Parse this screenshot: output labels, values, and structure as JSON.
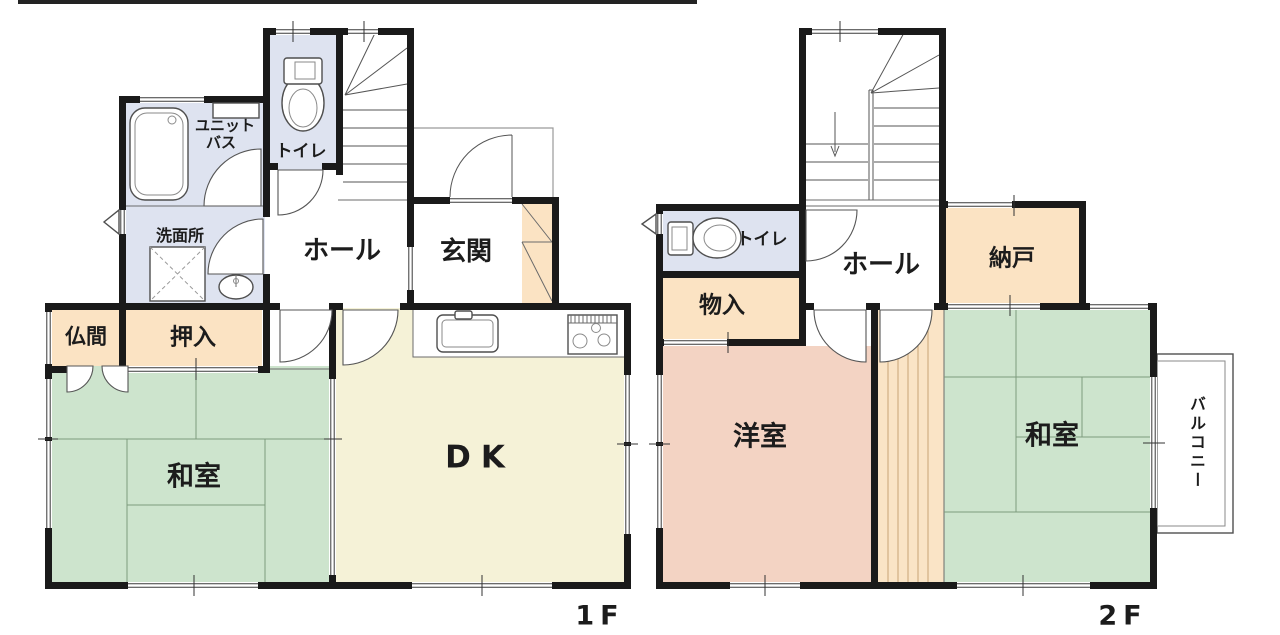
{
  "colors": {
    "wall": "#1a1a1a",
    "tatami_green": "#cde4cd",
    "wood_floor_yellow": "#f5f2d7",
    "storage_peach": "#fbe3c3",
    "western_room_pink": "#f3d3c3",
    "wet_area_blue": "#dee3f0",
    "corridor_wood_tan": "#fae4c6"
  },
  "floor1": {
    "floor_label": "1F",
    "rooms": {
      "washitsu": "和室",
      "dk": "DK",
      "hall": "ホール",
      "genkan": "玄関",
      "toilet": "トイレ",
      "unit_bath_line1": "ユニット",
      "unit_bath_line2": "バス",
      "senmenjo": "洗面所",
      "butsuma": "仏間",
      "oshiire": "押入"
    }
  },
  "floor2": {
    "floor_label": "2F",
    "rooms": {
      "yoshitsu": "洋室",
      "washitsu": "和室",
      "hall": "ホール",
      "nando": "納戸",
      "monoire": "物入",
      "toilet": "トイレ",
      "balcony": "バルコニー"
    }
  }
}
